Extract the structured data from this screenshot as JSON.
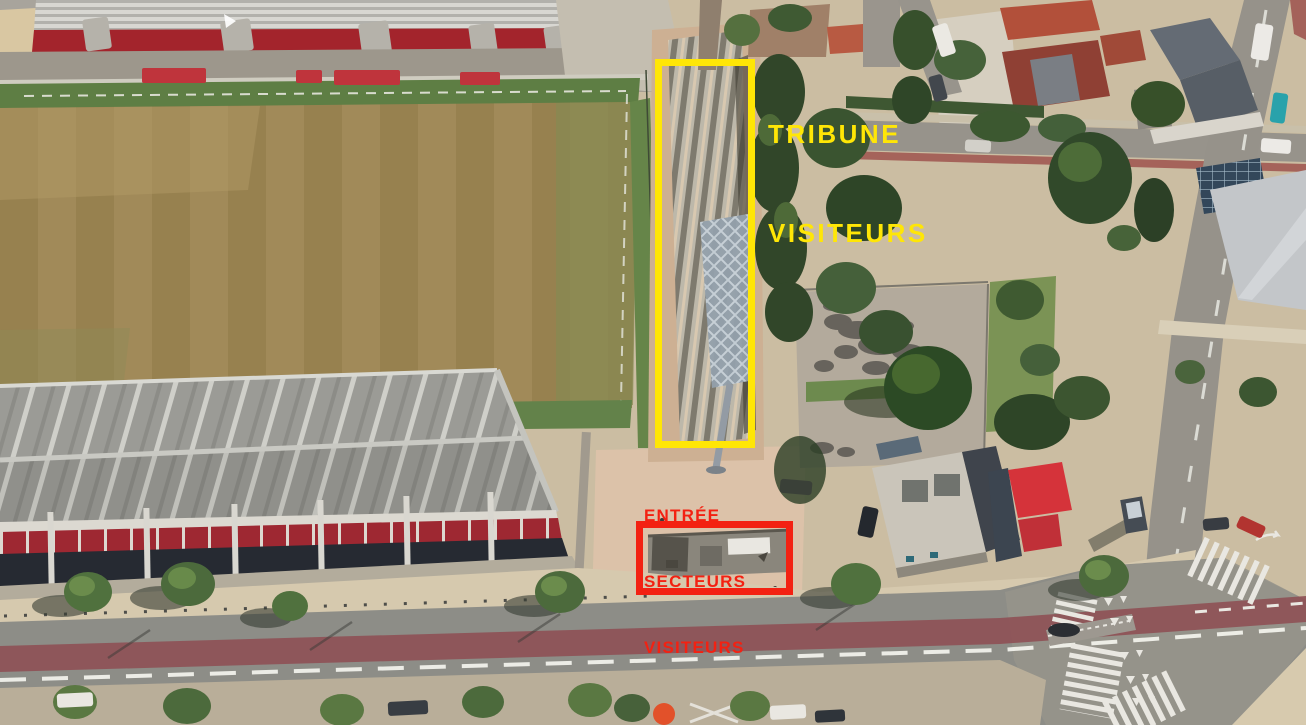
{
  "colors": {
    "highlight_yellow": "#FFE606",
    "highlight_red": "#F32112"
  },
  "annotations": {
    "tribune": {
      "line1": "TRIBUNE",
      "line2": "VISITEURS"
    },
    "entrance": {
      "line1": "ENTRÉE",
      "line2": "SECTEURS",
      "line3": "VISITEURS"
    }
  }
}
